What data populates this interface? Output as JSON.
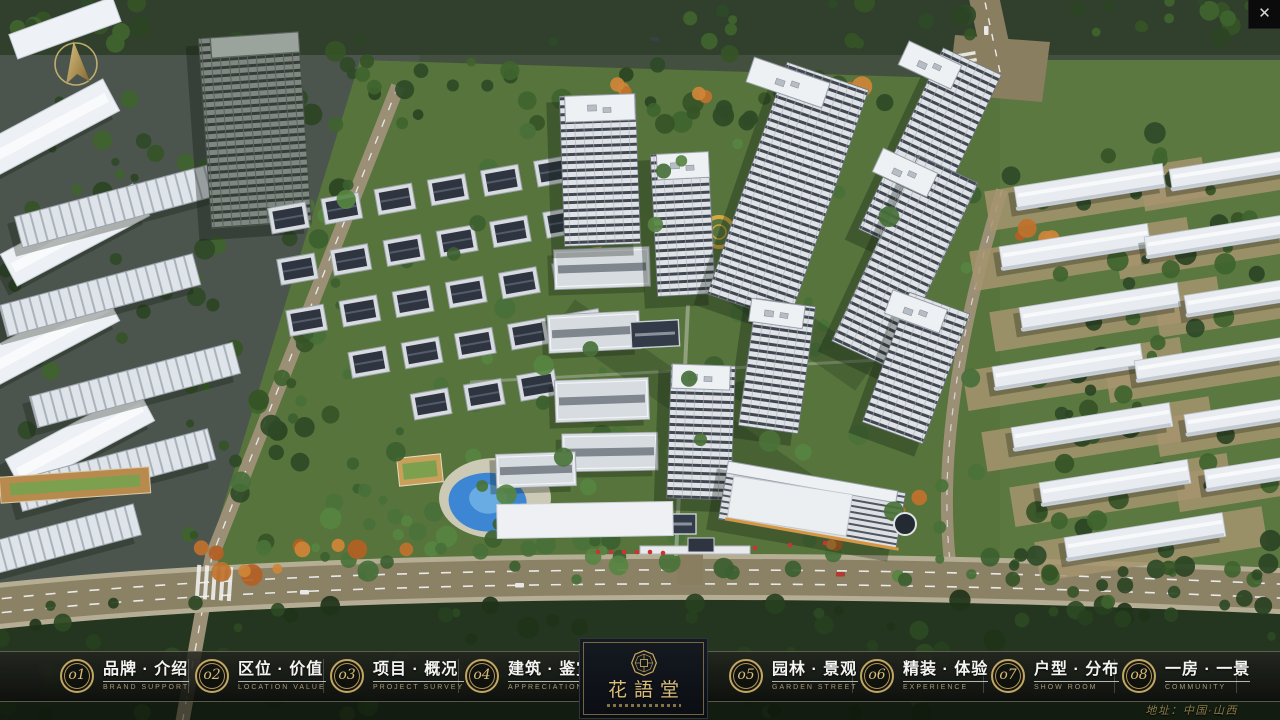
{
  "window": {
    "close_glyph": "✕"
  },
  "menu": {
    "items": [
      {
        "num": "o1",
        "zh": "品牌 · 介绍",
        "en": "BRAND SUPPORT"
      },
      {
        "num": "o2",
        "zh": "区位 · 价值",
        "en": "LOCATION VALUE"
      },
      {
        "num": "o3",
        "zh": "项目 · 概况",
        "en": "PROJECT SURVEY"
      },
      {
        "num": "o4",
        "zh": "建筑 · 鉴赏",
        "en": "APPRECIATION"
      },
      {
        "num": "o5",
        "zh": "园林 · 景观",
        "en": "GARDEN STREET"
      },
      {
        "num": "o6",
        "zh": "精装 · 体验",
        "en": "EXPERIENCE"
      },
      {
        "num": "o7",
        "zh": "户型 · 分布",
        "en": "SHOW ROOM"
      },
      {
        "num": "o8",
        "zh": "一房 · 一景",
        "en": "COMMUNITY"
      }
    ]
  },
  "logo": {
    "name": "花語堂"
  },
  "footer": {
    "address": "地址：中国·山西"
  },
  "colors": {
    "accent_gold": "#c9ab66",
    "river_blue": "#2f62cf",
    "bar_border": "#b7ad8c",
    "road_tan": "#8a7e60"
  }
}
